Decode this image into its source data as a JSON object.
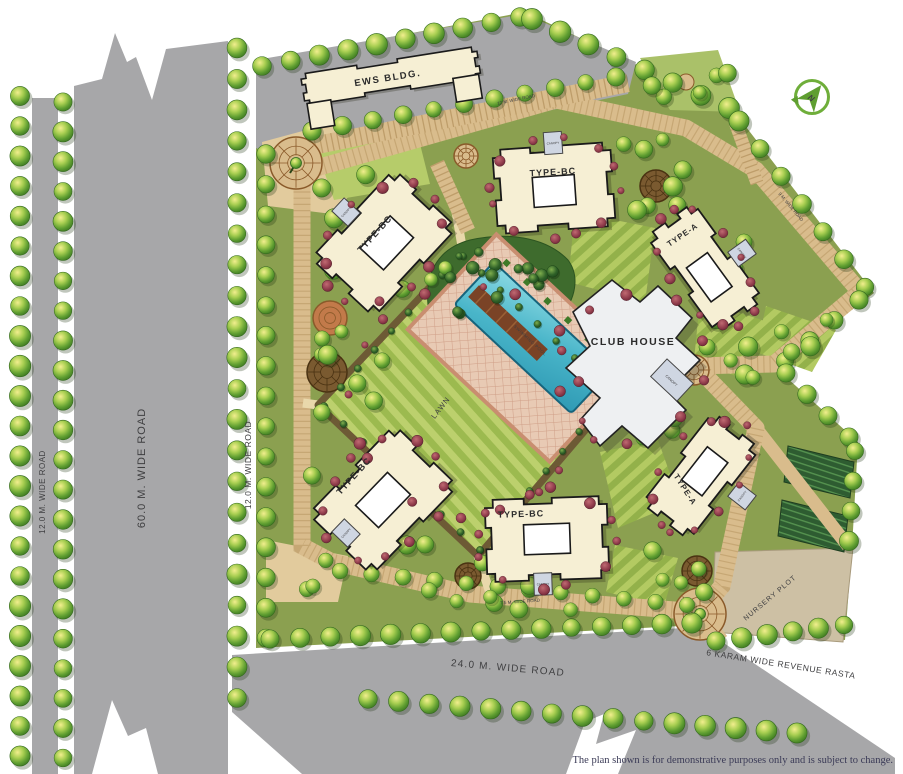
{
  "site": {
    "north_label": "N",
    "labels": {
      "ews_building": "EWS BLDG.",
      "club_house": "CLUB HOUSE",
      "canopy": "CANOPY",
      "lawn": "LAWN",
      "swimming_pool": "SWIMMING POOL",
      "nursery_plot": "NURSERY PLOT"
    },
    "buildings": [
      {
        "id": "type-bc-top",
        "label": "TYPE-BC"
      },
      {
        "id": "type-bc-left",
        "label": "TYPE-BC"
      },
      {
        "id": "type-a-right",
        "label": "TYPE-A"
      },
      {
        "id": "type-bc-bottom-left",
        "label": "TYPE-BC"
      },
      {
        "id": "type-bc-bottom-center",
        "label": "TYPE-BC"
      },
      {
        "id": "type-a-bottom-right",
        "label": "TYPE-A"
      }
    ],
    "roads": {
      "road_60m": "60.0 M. WIDE ROAD",
      "road_12m_left": "12.0 M. WIDE ROAD",
      "road_12m_right": "12.0 M. WIDE ROAD",
      "road_24m": "24.0 M. WIDE ROAD",
      "revenue_rasta": "6 KARAM WIDE REVENUE RASTA",
      "road_12m_internal": "12 M. WIDE ROAD",
      "road_9m_internal": "9 M. WIDE ROAD",
      "road_7_5m_internal": "7.5 M. WIDE ROAD"
    },
    "footer": {
      "disclaimer": "The plan shown is for demonstrative purposes only and is subject to change."
    },
    "colors": {
      "site_green": "#8ba050",
      "road_gray": "#a7a7a9",
      "ring_road_tan": "#d9bc8c",
      "building_cream": "#f6efd4",
      "club_house_white": "#eef0f2",
      "pool_blue": "#49b5c9",
      "lawn_light": "#bcd06d",
      "lawn_dark": "#9cba4f",
      "shrub_maroon": "#8e3a4a",
      "north_green": "#6fae3a"
    }
  }
}
